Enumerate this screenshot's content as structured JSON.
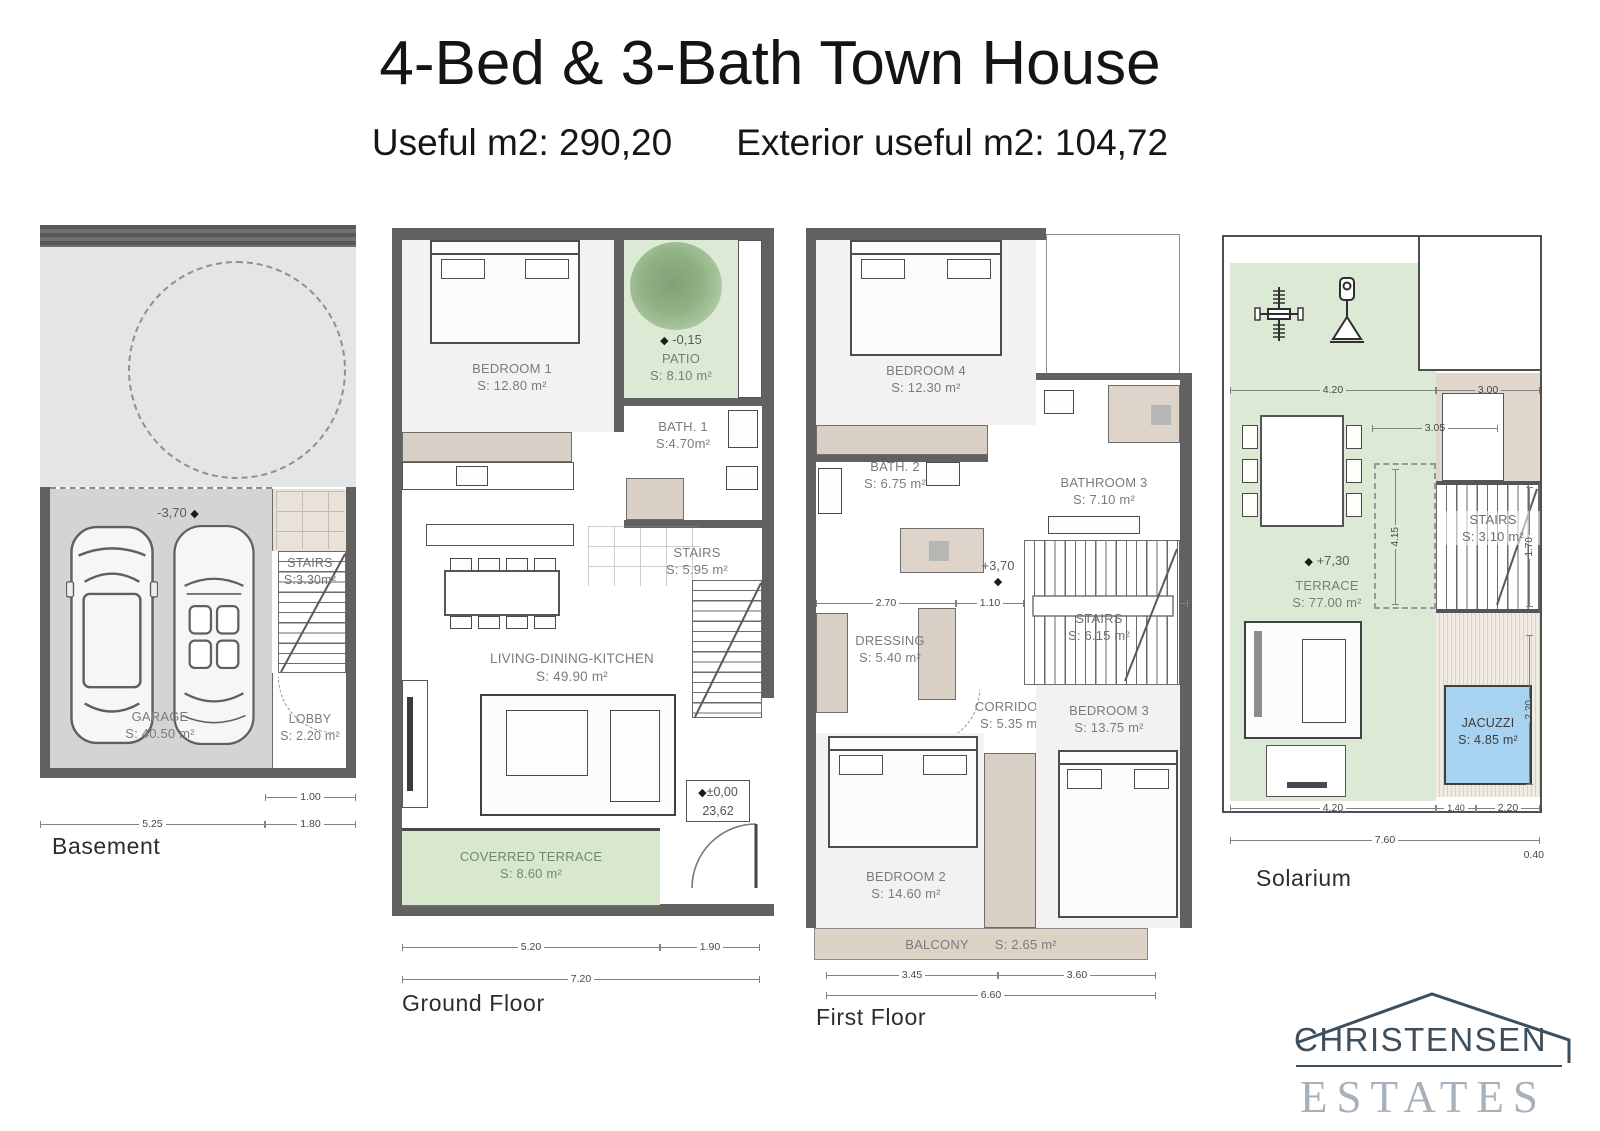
{
  "glyphs": {
    "diamond": "◆"
  },
  "header": {
    "title": "4-Bed & 3-Bath Town House",
    "subtitle_useful": "Useful m2: 290,20",
    "subtitle_exterior": "Exterior useful m2: 104,72"
  },
  "plans": {
    "basement": {
      "caption": "Basement",
      "level": "-3,70",
      "rooms": {
        "garage": {
          "name": "GARAGE",
          "area": "S: 40.50 m²"
        },
        "stairs": {
          "name": "STAIRS",
          "area": "S:3.30m²"
        },
        "lobby": {
          "name": "LOBBY",
          "area": "S: 2.20 m²"
        }
      },
      "dims": {
        "d100": "1.00",
        "d525": "5.25",
        "d180": "1.80"
      }
    },
    "ground": {
      "caption": "Ground Floor",
      "level_box": {
        "top": "±0,00",
        "bottom": "23,62"
      },
      "rooms": {
        "bedroom1": {
          "name": "BEDROOM 1",
          "area": "S: 12.80 m²"
        },
        "patio": {
          "name": "PATIO",
          "area": "S: 8.10 m²",
          "level": "-0,15"
        },
        "bath1": {
          "name": "BATH. 1",
          "area": "S:4.70m²"
        },
        "stairs": {
          "name": "STAIRS",
          "area": "S: 5.95 m²"
        },
        "living": {
          "name": "LIVING-DINING-KITCHEN",
          "area": "S: 49.90 m²"
        },
        "terrace": {
          "name": "COVERRED TERRACE",
          "area": "S: 8.60 m²"
        }
      },
      "dims": {
        "d520": "5.20",
        "d190": "1.90",
        "d720": "7.20"
      }
    },
    "first": {
      "caption": "First Floor",
      "level": "+3,70",
      "rooms": {
        "bedroom4": {
          "name": "BEDROOM 4",
          "area": "S: 12.30 m²"
        },
        "bath2": {
          "name": "BATH. 2",
          "area": "S: 6.75 m²"
        },
        "bathroom3": {
          "name": "BATHROOM 3",
          "area": "S: 7.10 m²"
        },
        "dressing": {
          "name": "DRESSING",
          "area": "S: 5.40 m²"
        },
        "stairs": {
          "name": "STAIRS",
          "area": "S: 6.15 m²"
        },
        "corridor": {
          "name": "CORRIDOR",
          "area": "S: 5.35 m²"
        },
        "bedroom3": {
          "name": "BEDROOM 3",
          "area": "S: 13.75 m²"
        },
        "bedroom2": {
          "name": "BEDROOM 2",
          "area": "S: 14.60 m²"
        },
        "balcony": {
          "name": "BALCONY",
          "area": "S: 2.65 m²"
        }
      },
      "dims": {
        "d270": "2.70",
        "d110": "1.10",
        "d240": "2.40",
        "d099": "0.99",
        "d345": "3.45",
        "d360": "3.60",
        "d660": "6.60"
      }
    },
    "solarium": {
      "caption": "Solarium",
      "level": "+7,30",
      "rooms": {
        "terrace": {
          "name": "TERRACE",
          "area": "S: 77.00 m²"
        },
        "stairs": {
          "name": "STAIRS",
          "area": "S: 3.10 m²"
        },
        "jacuzzi": {
          "name": "JACUZZI",
          "area": "S: 4.85 m²"
        }
      },
      "dims": {
        "top420": "4.20",
        "d300": "3.00",
        "d305": "3.05",
        "d415": "4.15",
        "bot420": "4.20",
        "d140": "1.40",
        "d220b": "2.20",
        "d760": "7.60",
        "d040": "0.40",
        "d170": "1.70",
        "d220r": "2.20"
      }
    }
  },
  "logo": {
    "name": "CHRISTENSEN",
    "word": "ESTATES"
  },
  "colors": {
    "terrace_green": "#dcead5",
    "wood_tan": "#d9d0c5",
    "jacuzzi_blue": "#a7d3f0",
    "wall_gray": "#616161",
    "logo_navy": "#3d4e5c",
    "logo_gray": "#a6b1bb"
  }
}
